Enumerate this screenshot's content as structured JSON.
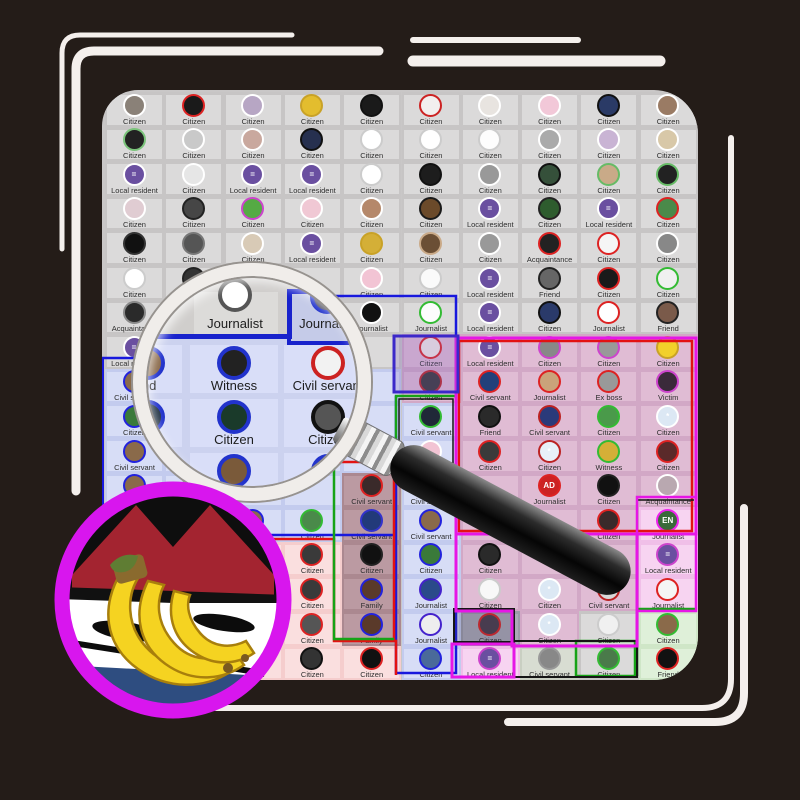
{
  "app": {
    "name": "hidden-suspect-grid-game"
  },
  "colors": {
    "background": "#241c18",
    "panel": "#c9c7c7",
    "deco_line": "#f4efec",
    "label_text": "#2e2e2e",
    "stroke_blue": "#1818dd",
    "stroke_red": "#e31212",
    "stroke_green": "#16a316",
    "stroke_magenta": "#e616e6",
    "stroke_navy": "#3b28c9",
    "stroke_black": "#151515",
    "suspect_ring": "#d816ee",
    "suspect_hat": "#a32430",
    "suspect_coat": "#2e4d80",
    "suspect_banana": "#f5d321"
  },
  "region_styles": {
    "g": {
      "bg": "#c7c5c5",
      "tile": "#dbdada"
    },
    "b": {
      "bg": "#c3cbee",
      "tile": "#d7ddf6"
    },
    "r": {
      "bg": "#f5cdcd",
      "tile": "#fadfdf"
    },
    "m": {
      "bg": "#d2a8c6",
      "tile": "#e0bcd4"
    },
    "d": {
      "bg": "#ab8890",
      "tile": "#bb9aa2"
    },
    "p": {
      "bg": "#f0bfe8",
      "tile": "#f7d4f1"
    },
    "n": {
      "bg": "#cfe6c7",
      "tile": "#dff0d9"
    },
    "e": {
      "bg": "#c9cfc2",
      "tile": "#d8ddd2"
    },
    "k": {
      "bg": "#9c9aa8",
      "tile": "#acaab8"
    }
  },
  "grid": {
    "region_map": [
      "gggggggggg",
      "gggggggggg",
      "gggggggggg",
      "gggggggggg",
      "gggggggggg",
      "gggggggggg",
      "gggggggggg",
      "gggggmmmmm",
      "bbbbbmmmmm",
      "bbbbbbmmmm",
      "bbbbbbmmmm",
      "bbbbdbmmmm",
      "bbbbdbmmmp",
      "rrrrdbmmmp",
      "rrrrdbmmmp",
      "rrrrdbkmgn",
      "rrrrrbpegn"
    ],
    "rows": [
      {
        "cells": [
          [
            "Citizen",
            "#ffffff",
            "#8a8178"
          ],
          [
            "Citizen",
            "#dd2222",
            "#1a1a1a"
          ],
          [
            "Citizen",
            "#ffffff",
            "#b7a6c4"
          ],
          [
            "Citizen",
            "#c9a227",
            "#e3bd2e"
          ],
          [
            "Citizen",
            "#111111",
            "#1a1a1a"
          ],
          [
            "Citizen",
            "#cc2222",
            "#f2efee"
          ],
          [
            "Citizen",
            "#ffffff",
            "#e8e4e0"
          ],
          [
            "Citizen",
            "#ffffff",
            "#f2c8d8"
          ],
          [
            "Citizen",
            "#111111",
            "#2a3a66"
          ],
          [
            "Citizen",
            "#ffffff",
            "#9a7b64"
          ]
        ]
      },
      {
        "cells": [
          [
            "Citizen",
            "#7bc47b",
            "#222222"
          ],
          [
            "Citizen",
            "#ffffff",
            "#c9c9c9"
          ],
          [
            "Citizen",
            "#ffffff",
            "#c9a89e"
          ],
          [
            "Citizen",
            "#111111",
            "#26304f"
          ],
          [
            "Citizen",
            "#cccccc",
            "#ffffff"
          ],
          [
            "Citizen",
            "#cccccc",
            "#ffffff"
          ],
          [
            "Citizen",
            "#cccccc",
            "#fdfdfd"
          ],
          [
            "Citizen",
            "#ffffff",
            "#aaaaaa"
          ],
          [
            "Citizen",
            "#ffffff",
            "#c9b4d4"
          ],
          [
            "Citizen",
            "#ffffff",
            "#d8c8a8"
          ]
        ]
      },
      {
        "cells": [
          [
            "Local resident",
            "#ffffff",
            "#6a4fa0",
            "="
          ],
          [
            "Citizen",
            "#ffffff",
            "#e6e6e6"
          ],
          [
            "Local resident",
            "#ffffff",
            "#6a4fa0",
            "="
          ],
          [
            "Local resident",
            "#ffffff",
            "#6a4fa0",
            "="
          ],
          [
            "Citizen",
            "#cccccc",
            "#ffffff"
          ],
          [
            "Citizen",
            "#111111",
            "#1d1d1d"
          ],
          [
            "Citizen",
            "#ffffff",
            "#999999"
          ],
          [
            "Citizen",
            "#111111",
            "#35503a"
          ],
          [
            "Citizen",
            "#66bb66",
            "#c9aa88"
          ],
          [
            "Citizen",
            "#66bb66",
            "#222222"
          ]
        ]
      },
      {
        "cells": [
          [
            "Citizen",
            "#ffffff",
            "#e0ccd2"
          ],
          [
            "Citizen",
            "#222222",
            "#464646"
          ],
          [
            "Citizen",
            "#cc44cc",
            "#55aa44"
          ],
          [
            "Citizen",
            "#ffffff",
            "#f0c8d4"
          ],
          [
            "Citizen",
            "#ffffff",
            "#b5886a"
          ],
          [
            "Citizen",
            "#1a1a1a",
            "#6b4a2a"
          ],
          [
            "Local resident",
            "#ffffff",
            "#6a4fa0",
            "="
          ],
          [
            "Citizen",
            "#222222",
            "#2e5c2e"
          ],
          [
            "Local resident",
            "#ffffff",
            "#6a4fa0",
            "="
          ],
          [
            "Citizen",
            "#dd2222",
            "#4a8a4a"
          ]
        ]
      },
      {
        "cells": [
          [
            "Citizen",
            "#333333",
            "#111111"
          ],
          [
            "Citizen",
            "#777777",
            "#555555"
          ],
          [
            "Citizen",
            "#ffffff",
            "#d8cab6"
          ],
          [
            "Local resident",
            "#ffffff",
            "#6a4fa0",
            "="
          ],
          [
            "Citizen",
            "#c9a227",
            "#d4af37"
          ],
          [
            "Citizen",
            "#caaa88",
            "#6b4f35"
          ],
          [
            "Citizen",
            "#ffffff",
            "#999999"
          ],
          [
            "Acquaintance",
            "#dd2222",
            "#222222"
          ],
          [
            "Citizen",
            "#dd2222",
            "#f5f5f5"
          ],
          [
            "Citizen",
            "#ffffff",
            "#888888"
          ]
        ]
      },
      {
        "cells": [
          [
            "Citizen",
            "#cccccc",
            "#ffffff"
          ],
          [
            "Citizen",
            "#222222",
            "#333333"
          ],
          null,
          null,
          [
            "Citizen",
            "#ffffff",
            "#f2c4d4"
          ],
          [
            "Citizen",
            "#cccccc",
            "#fafafa"
          ],
          [
            "Local resident",
            "#ffffff",
            "#6a4fa0",
            "="
          ],
          [
            "Friend",
            "#222222",
            "#666666"
          ],
          [
            "Citizen",
            "#dd2222",
            "#1a1a1a"
          ],
          [
            "Citizen",
            "#33bb33",
            "#f0f0f0"
          ]
        ]
      },
      {
        "cells": [
          [
            "Acquaintance",
            "#888888",
            "#2a2a2a"
          ],
          null,
          null,
          null,
          [
            "Journalist",
            "#ffffff",
            "#111111"
          ],
          [
            "Journalist",
            "#33bb33",
            "#fcfcfc"
          ],
          [
            "Local resident",
            "#ffffff",
            "#6a4fa0",
            "="
          ],
          [
            "Citizen",
            "#111111",
            "#2a3a6a"
          ],
          [
            "Journalist",
            "#dd2222",
            "#ffffff",
            "E"
          ],
          [
            "Friend",
            "#222222",
            "#7a5a4a"
          ]
        ]
      },
      {
        "cells": [
          [
            "Local resident",
            "#ffffff",
            "#6a4fa0",
            "="
          ],
          null,
          null,
          null,
          null,
          [
            "Citizen",
            "#dd2222",
            "#f5eee8"
          ],
          [
            "Local resident",
            "#ffffff",
            "#6a4fa0",
            "="
          ],
          [
            "Citizen",
            "#cc44cc",
            "#888888"
          ],
          [
            "Citizen",
            "#cc44cc",
            "#999999"
          ],
          [
            "Citizen",
            "#c9a227",
            "#f2d02a"
          ]
        ]
      },
      {
        "cells": [
          [
            "Civil servant",
            "#2222dd",
            "#8a6a4a"
          ],
          null,
          null,
          null,
          null,
          [
            "Citizen",
            "#bb2222",
            "#333333"
          ],
          [
            "Civil servant",
            "#dd2222",
            "#22407a"
          ],
          [
            "Journalist",
            "#dd2222",
            "#caa37a"
          ],
          [
            "Ex boss",
            "#dd2222",
            "#999999"
          ],
          [
            "Victim",
            "#cc44cc",
            "#3a2a3a"
          ]
        ]
      },
      {
        "cells": [
          [
            "Citizen",
            "#2222dd",
            "#3a7a3a"
          ],
          null,
          null,
          null,
          null,
          [
            "Civil servant",
            "#33bb33",
            "#202838"
          ],
          [
            "Friend",
            "#111111",
            "#2a2a2a"
          ],
          [
            "Civil servant",
            "#bb2222",
            "#2a3a7a"
          ],
          [
            "Citizen",
            "#33bb33",
            "#4a9a4a"
          ],
          [
            "Citizen",
            "#ffffff",
            "#dce8f4",
            "*"
          ]
        ]
      },
      {
        "cells": [
          [
            "Civil servant",
            "#2222dd",
            "#8a6a4a"
          ],
          null,
          null,
          null,
          null,
          [
            "Civil servant",
            "#ffffff",
            "#f2c4d4"
          ],
          [
            "Citizen",
            "#dd2222",
            "#3a3a3a"
          ],
          [
            "Citizen",
            "#bb2222",
            "#e8f0f8",
            "*"
          ],
          [
            "Witness",
            "#33bb33",
            "#d4af37"
          ],
          [
            "Citizen",
            "#dd2222",
            "#5a2a2a"
          ]
        ]
      },
      {
        "cells": [
          [
            "Civil servant",
            "#2222dd",
            "#8a6a4a"
          ],
          [
            "Citizen",
            "#999999",
            "#777777"
          ],
          null,
          null,
          [
            "Civil servant",
            "#dd2222",
            "#3a2a2a"
          ],
          [
            "Civil servant",
            "#dd2222",
            "#4a3a3a"
          ],
          null,
          [
            "Journalist",
            "#dd2222",
            "#cc2222",
            "AD"
          ],
          [
            "Citizen",
            "#222222",
            "#111111"
          ],
          [
            "Acquaintance",
            "#ffffff",
            "#b9a8b0"
          ]
        ]
      },
      {
        "cells": [
          null,
          null,
          [
            "Civil servant",
            "#2222dd",
            "#8a6a4a"
          ],
          [
            "Citizen",
            "#33bb33",
            "#4a8a4a"
          ],
          [
            "Civil servant",
            "#3333cc",
            "#223a7a"
          ],
          [
            "Civil servant",
            "#2222dd",
            "#8a6a4a"
          ],
          null,
          null,
          [
            "Citizen",
            "#dd2222",
            "#3a2a2a"
          ],
          [
            "Journalist",
            "#ee22ee",
            "#3a6a3a",
            "EN"
          ]
        ]
      },
      {
        "cells": [
          null,
          null,
          null,
          [
            "Citizen",
            "#dd2222",
            "#3a3a3a"
          ],
          [
            "Citizen",
            "#222222",
            "#111111"
          ],
          [
            "Citizen",
            "#2222dd",
            "#3a7a3a"
          ],
          [
            "Citizen",
            "#111111",
            "#2a2a2a"
          ],
          null,
          null,
          [
            "Local resident",
            "#cc44cc",
            "#6a4fa0",
            "="
          ]
        ]
      },
      {
        "cells": [
          null,
          null,
          null,
          [
            "Citizen",
            "#dd2222",
            "#3a3a3a"
          ],
          [
            "Family",
            "#2222dd",
            "#5a3a2a"
          ],
          [
            "Journalist",
            "#4422cc",
            "#2a4a8a"
          ],
          [
            "Citizen",
            "#cccccc",
            "#f8f8f8"
          ],
          [
            "Citizen",
            "#ffffff",
            "#dce8f4",
            "*"
          ],
          [
            "Civil servant",
            "#bb2222",
            "#d8d8d8"
          ],
          [
            "Journalist",
            "#dd2222",
            "#f5f5f5"
          ]
        ]
      },
      {
        "cells": [
          null,
          null,
          null,
          [
            "Citizen",
            "#dd2222",
            "#555555"
          ],
          [
            "Family",
            "#2222dd",
            "#5a3a2a"
          ],
          [
            "Journalist",
            "#4422cc",
            "#eeeeee"
          ],
          [
            "Citizen",
            "#dd2222",
            "#4a3a4a"
          ],
          [
            "Citizen",
            "#ffffff",
            "#dce8f4",
            "*"
          ],
          [
            "Citizen",
            "#cccccc",
            "#f0f0f0"
          ],
          [
            "Citizen",
            "#33bb33",
            "#8a6a4a"
          ]
        ]
      },
      {
        "cells": [
          null,
          null,
          [
            "Citizen",
            "#999999",
            "#888888"
          ],
          [
            "Citizen",
            "#111111",
            "#333333"
          ],
          [
            "Citizen",
            "#dd2222",
            "#111111"
          ],
          [
            "Citizen",
            "#2222dd",
            "#4a6a9a"
          ],
          [
            "Local resident",
            "#cc44cc",
            "#6a4fa0",
            "="
          ],
          [
            "Civil servant",
            "#999999",
            "#888888"
          ],
          [
            "Citizen",
            "#33bb33",
            "#4a7a4a"
          ],
          [
            "Friend",
            "#dd2222",
            "#111111"
          ]
        ]
      }
    ]
  },
  "magnifier": {
    "top_row": [
      {
        "label": "Journalist",
        "ring": "#555555",
        "fill": "#ffffff",
        "boxed": false
      },
      {
        "label": "Journalist",
        "ring": "#2233cc",
        "fill": "#555566",
        "boxed": true
      }
    ],
    "rows": [
      [
        {
          "label": "Witness",
          "ring": "#2233cc",
          "fill": "#222222"
        },
        {
          "label": "Civil servant",
          "ring": "#cc2222",
          "fill": "#f2f2f2"
        }
      ],
      [
        {
          "label": "Citizen",
          "ring": "#2233cc",
          "fill": "#1a3a2a"
        },
        {
          "label": "Citizen",
          "ring": "#111111",
          "fill": "#555555"
        }
      ],
      [
        {
          "label": "Civil servant",
          "ring": "#2233cc",
          "fill": "#7a5a3a"
        },
        {
          "label": "Family",
          "ring": "#2233cc",
          "fill": "#4a2a2a"
        }
      ]
    ],
    "partial_left": [
      {
        "label": "Friend",
        "ring": "#2233cc",
        "fill": "#8a6a4a"
      },
      {
        "label": "Citizen",
        "ring": "#2233cc",
        "fill": "#223344"
      }
    ]
  }
}
